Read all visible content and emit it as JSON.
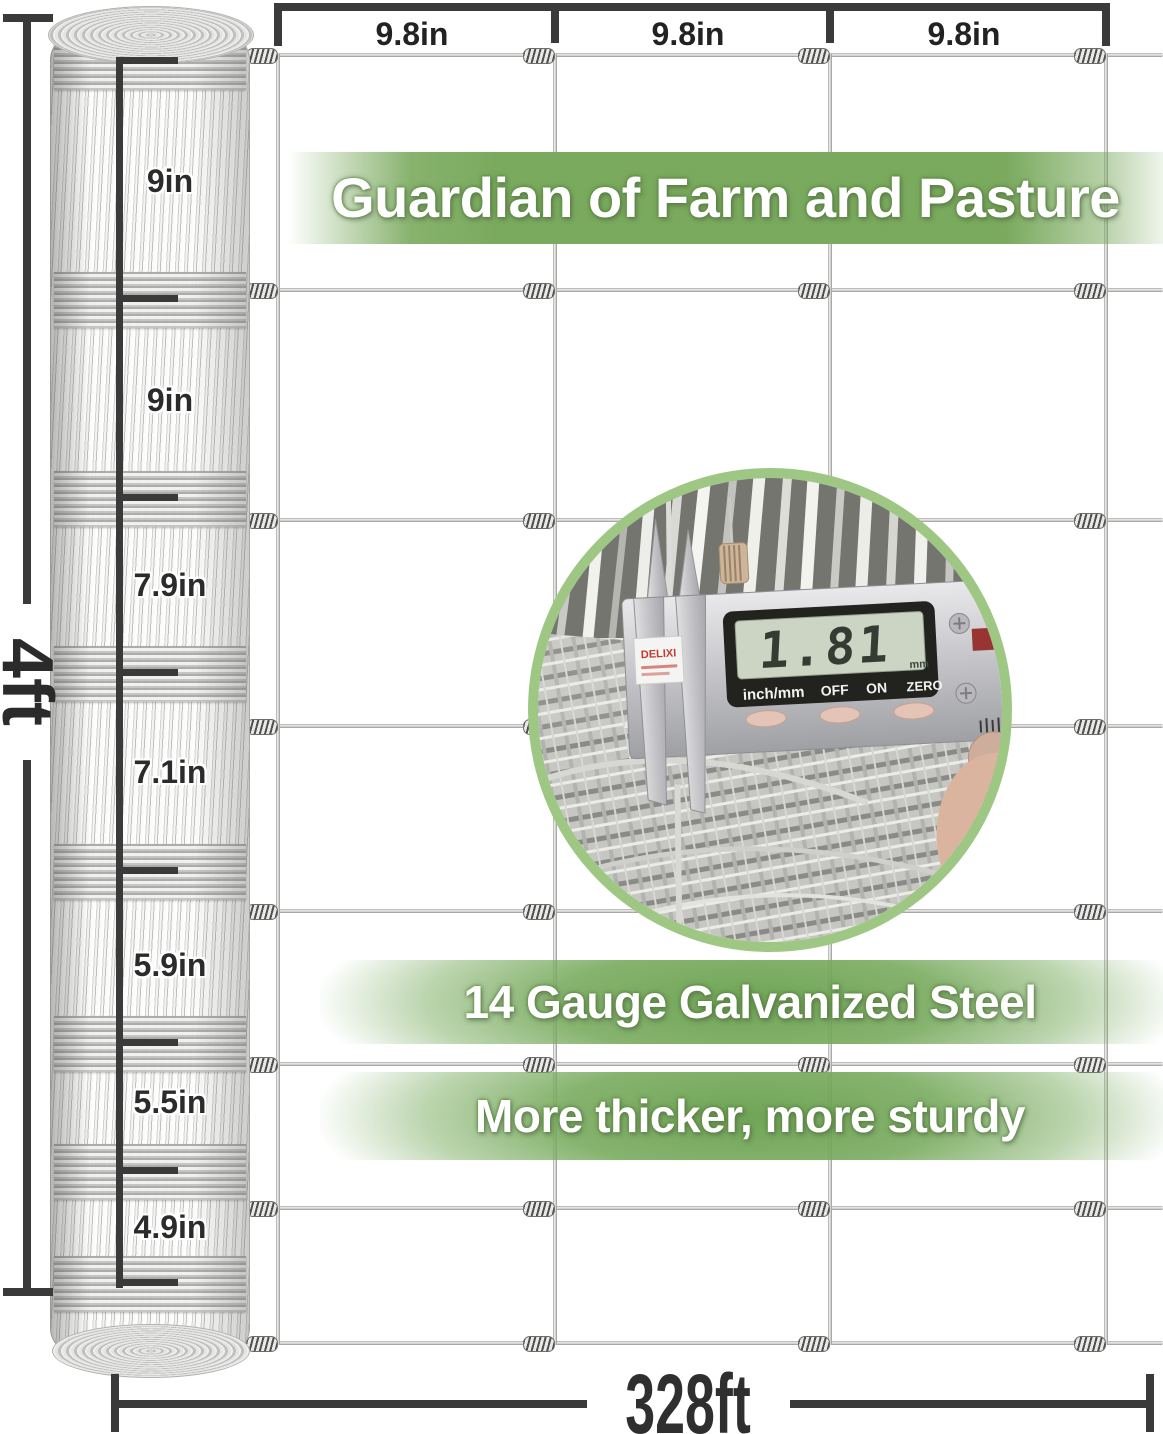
{
  "banners": {
    "main": "Guardian of Farm and Pasture",
    "feature1": "14 Gauge Galvanized Steel",
    "feature2": "More thicker, more sturdy"
  },
  "dimensions": {
    "fence_height": "4ft",
    "roll_length": "328ft",
    "vertical_wire_spacing": [
      "9.8in",
      "9.8in",
      "9.8in"
    ],
    "horizontal_wire_spacing": [
      "9in",
      "9in",
      "7.9in",
      "7.1in",
      "5.9in",
      "5.5in",
      "4.9in"
    ]
  },
  "caliper_inset": {
    "brand": "DELIXI",
    "lcd_value": "1.81",
    "lcd_unit": "mm",
    "button_labels": [
      "inch/mm",
      "OFF",
      "ON",
      "ZERO"
    ]
  },
  "colors": {
    "band_green": "#7aaa5e",
    "band_green_deep": "#68a04e",
    "dimension_line": "#3a3a3a",
    "circle_border": "#9fc784"
  }
}
